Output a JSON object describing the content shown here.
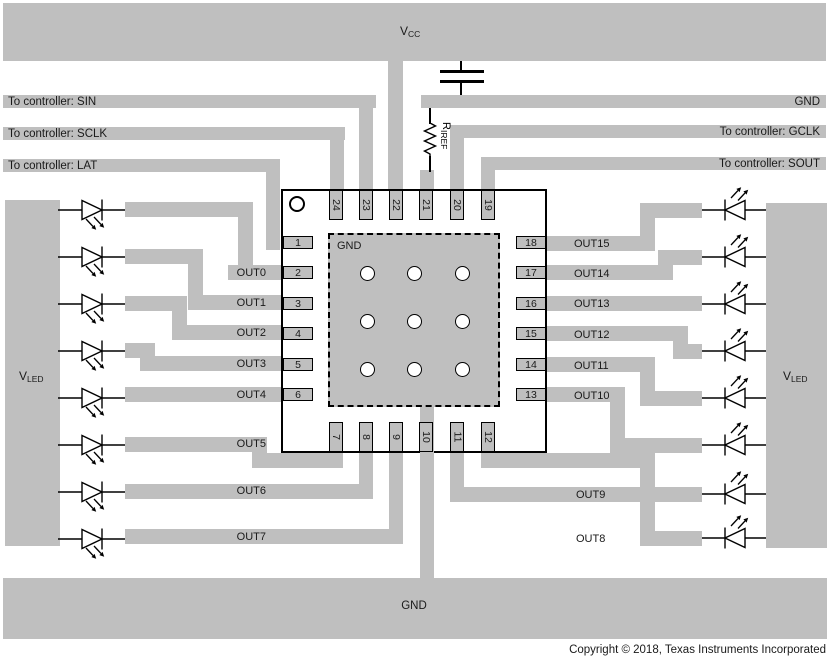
{
  "labels": {
    "vcc": {
      "main": "V",
      "sub": "CC"
    },
    "vled_left": {
      "main": "V",
      "sub": "LED"
    },
    "vled_right": {
      "main": "V",
      "sub": "LED"
    },
    "riref": {
      "main": "R",
      "sub": "IREF"
    },
    "sin": "To controller: SIN",
    "sclk": "To controller: SCLK",
    "lat": "To controller: LAT",
    "gnd_bar": "GND",
    "gclk": "To controller: GCLK",
    "sout": "To controller: SOUT",
    "pad_gnd": "GND",
    "gnd_plane": "GND",
    "copyright": "Copyright © 2018, Texas Instruments Incorporated"
  },
  "package": {
    "pins_top": [
      "24",
      "23",
      "22",
      "21",
      "20",
      "19"
    ],
    "pins_bottom": [
      "7",
      "8",
      "9",
      "10",
      "11",
      "12"
    ],
    "pins_left": [
      "1",
      "2",
      "3",
      "4",
      "5",
      "6"
    ],
    "pins_right": [
      "18",
      "17",
      "16",
      "15",
      "14",
      "13"
    ]
  },
  "outputs": {
    "left": [
      "OUT0",
      "OUT1",
      "OUT2",
      "OUT3",
      "OUT4",
      "OUT5",
      "OUT6",
      "OUT7"
    ],
    "right": [
      "OUT15",
      "OUT14",
      "OUT13",
      "OUT12",
      "OUT11",
      "OUT10",
      "OUT9",
      "OUT8"
    ]
  },
  "colors": {
    "trace": "#bfbfbf",
    "outline": "#000000",
    "background": "#ffffff"
  }
}
